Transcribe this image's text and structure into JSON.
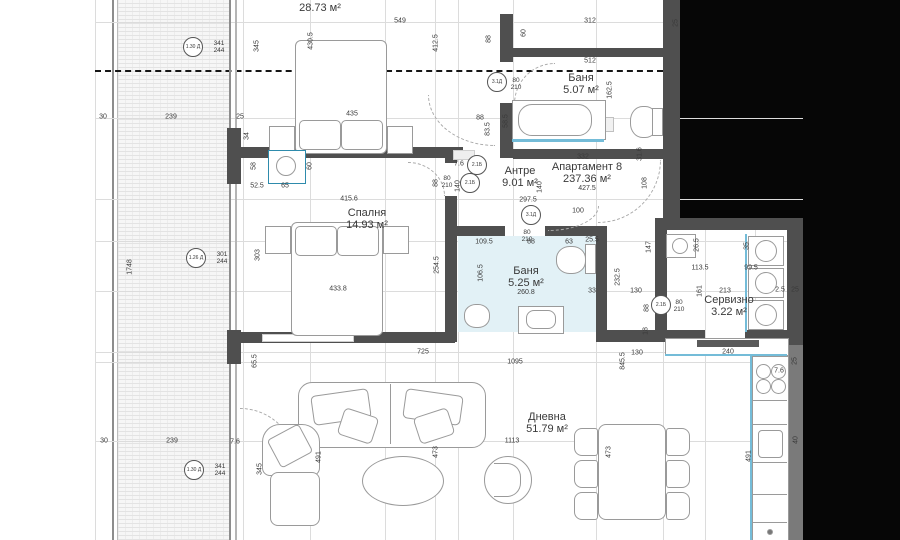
{
  "plan": {
    "colors": {
      "wall": "#4f4f4f",
      "background_outside": "#060606",
      "bath_floor_tint": "#e2f1f6",
      "fixture_blue": "#74bcd8"
    },
    "rooms": [
      {
        "lines": [
          "Спалня",
          "28.73 м²"
        ],
        "x": 320,
        "y": 2
      },
      {
        "lines": [
          "Баня",
          "5.07 м²"
        ],
        "x": 581,
        "y": 84
      },
      {
        "lines": [
          "Антре",
          "9.01 м²"
        ],
        "x": 520,
        "y": 177
      },
      {
        "lines": [
          "Апартамент  8",
          "237.36 м²"
        ],
        "sub": "427.5",
        "x": 587,
        "y": 177
      },
      {
        "lines": [
          "Спалня",
          "14.93 м²"
        ],
        "x": 367,
        "y": 219
      },
      {
        "lines": [
          "Баня",
          "5.25 м²"
        ],
        "sub": "260.8",
        "x": 526,
        "y": 281
      },
      {
        "lines": [
          "Сервизно",
          "3.22 м²"
        ],
        "x": 729,
        "y": 306
      },
      {
        "lines": [
          "Дневна",
          "51.79 м²"
        ],
        "x": 547,
        "y": 423
      }
    ],
    "dims": [
      {
        "t": "30",
        "x": 103,
        "y": 117
      },
      {
        "t": "239",
        "x": 171,
        "y": 117
      },
      {
        "t": "25",
        "x": 240,
        "y": 117
      },
      {
        "t": "549",
        "x": 400,
        "y": 21
      },
      {
        "t": "435",
        "x": 352,
        "y": 114
      },
      {
        "t": "312",
        "x": 590,
        "y": 21
      },
      {
        "t": "512",
        "x": 590,
        "y": 61
      },
      {
        "t": "52.5",
        "x": 257,
        "y": 186
      },
      {
        "t": "65",
        "x": 285,
        "y": 186
      },
      {
        "t": "415.6",
        "x": 349,
        "y": 199
      },
      {
        "t": "433.8",
        "x": 338,
        "y": 289
      },
      {
        "t": "297.5",
        "x": 528,
        "y": 200
      },
      {
        "t": "100",
        "x": 578,
        "y": 211
      },
      {
        "t": "332",
        "x": 583,
        "y": 157
      },
      {
        "t": "109.5",
        "x": 484,
        "y": 242
      },
      {
        "t": "88",
        "x": 531,
        "y": 242
      },
      {
        "t": "63",
        "x": 569,
        "y": 242
      },
      {
        "t": "25.5",
        "x": 592,
        "y": 240
      },
      {
        "t": "113.5",
        "x": 700,
        "y": 268
      },
      {
        "t": "99.5",
        "x": 751,
        "y": 268
      },
      {
        "t": "213",
        "x": 725,
        "y": 291
      },
      {
        "t": "2.5",
        "x": 780,
        "y": 290
      },
      {
        "t": "25",
        "x": 795,
        "y": 290
      },
      {
        "t": "725",
        "x": 423,
        "y": 352
      },
      {
        "t": "1095",
        "x": 515,
        "y": 362
      },
      {
        "t": "130",
        "x": 637,
        "y": 353
      },
      {
        "t": "240",
        "x": 728,
        "y": 352
      },
      {
        "t": "1113",
        "x": 512,
        "y": 441
      },
      {
        "t": "30",
        "x": 104,
        "y": 441
      },
      {
        "t": "239",
        "x": 172,
        "y": 441
      },
      {
        "t": "7.6",
        "x": 235,
        "y": 442
      },
      {
        "t": "7.6",
        "x": 459,
        "y": 164
      },
      {
        "t": "7.6",
        "x": 779,
        "y": 371
      },
      {
        "t": "33",
        "x": 592,
        "y": 291
      },
      {
        "t": "130",
        "x": 636,
        "y": 291
      },
      {
        "t": "88",
        "x": 480,
        "y": 118
      },
      {
        "t": "345",
        "x": 257,
        "y": 46,
        "v": true
      },
      {
        "t": "430.5",
        "x": 311,
        "y": 41,
        "v": true
      },
      {
        "t": "412.5",
        "x": 436,
        "y": 43,
        "v": true
      },
      {
        "t": "88",
        "x": 489,
        "y": 39,
        "v": true
      },
      {
        "t": "60",
        "x": 524,
        "y": 33,
        "v": true
      },
      {
        "t": "25",
        "x": 676,
        "y": 23,
        "v": true
      },
      {
        "t": "162.5",
        "x": 610,
        "y": 90,
        "v": true
      },
      {
        "t": "58.5",
        "x": 506,
        "y": 121,
        "v": true
      },
      {
        "t": "83.5",
        "x": 488,
        "y": 129,
        "v": true
      },
      {
        "t": "34",
        "x": 247,
        "y": 136,
        "v": true
      },
      {
        "t": "58",
        "x": 254,
        "y": 166,
        "v": true
      },
      {
        "t": "60",
        "x": 310,
        "y": 166,
        "v": true
      },
      {
        "t": "1748",
        "x": 130,
        "y": 267,
        "v": true
      },
      {
        "t": "303",
        "x": 258,
        "y": 255,
        "v": true
      },
      {
        "t": "345",
        "x": 260,
        "y": 469,
        "v": true
      },
      {
        "t": "140",
        "x": 458,
        "y": 186,
        "v": true
      },
      {
        "t": "140",
        "x": 540,
        "y": 187,
        "v": true
      },
      {
        "t": "108",
        "x": 645,
        "y": 183,
        "v": true
      },
      {
        "t": "31.6",
        "x": 640,
        "y": 154,
        "v": true
      },
      {
        "t": "147",
        "x": 649,
        "y": 247,
        "v": true
      },
      {
        "t": "254.5",
        "x": 437,
        "y": 265,
        "v": true
      },
      {
        "t": "106.5",
        "x": 481,
        "y": 273,
        "v": true
      },
      {
        "t": "232.5",
        "x": 618,
        "y": 277,
        "v": true
      },
      {
        "t": "88",
        "x": 647,
        "y": 308,
        "v": true
      },
      {
        "t": "18",
        "x": 646,
        "y": 331,
        "v": true
      },
      {
        "t": "161",
        "x": 700,
        "y": 291,
        "v": true
      },
      {
        "t": "88",
        "x": 436,
        "y": 183,
        "v": true
      },
      {
        "t": "65.5",
        "x": 255,
        "y": 361,
        "v": true
      },
      {
        "t": "845.5",
        "x": 623,
        "y": 361,
        "v": true
      },
      {
        "t": "473",
        "x": 436,
        "y": 452,
        "v": true
      },
      {
        "t": "473",
        "x": 609,
        "y": 452,
        "v": true
      },
      {
        "t": "491",
        "x": 319,
        "y": 457,
        "v": true
      },
      {
        "t": "491",
        "x": 749,
        "y": 456,
        "v": true
      },
      {
        "t": "25",
        "x": 795,
        "y": 361,
        "v": true
      },
      {
        "t": "40",
        "x": 796,
        "y": 440,
        "v": true
      },
      {
        "t": "35",
        "x": 747,
        "y": 246,
        "v": true
      },
      {
        "t": "26.5",
        "x": 697,
        "y": 245,
        "v": true
      }
    ],
    "door_sizes": [
      {
        "lines": [
          "80",
          "210"
        ],
        "x": 516,
        "y": 84
      },
      {
        "lines": [
          "80",
          "210"
        ],
        "x": 447,
        "y": 182
      },
      {
        "lines": [
          "80",
          "210"
        ],
        "x": 527,
        "y": 236
      },
      {
        "lines": [
          "80",
          "210"
        ],
        "x": 679,
        "y": 306
      }
    ],
    "door_tags": [
      {
        "t": "2.1Б",
        "x": 477,
        "y": 165
      },
      {
        "t": "2.1Б",
        "x": 470,
        "y": 183
      },
      {
        "t": "3.1Д",
        "x": 531,
        "y": 215
      },
      {
        "t": "3.1Д",
        "x": 497,
        "y": 82
      },
      {
        "t": "2.1Б",
        "x": 661,
        "y": 305
      }
    ],
    "window_tags": [
      {
        "t": "1.30 Д",
        "x": 193,
        "y": 47,
        "lines": [
          "341",
          "244"
        ]
      },
      {
        "t": "1.26 Д",
        "x": 196,
        "y": 258,
        "lines": [
          "301",
          "244"
        ]
      },
      {
        "t": "1.30 Д",
        "x": 194,
        "y": 470,
        "lines": [
          "341",
          "244"
        ]
      }
    ]
  }
}
